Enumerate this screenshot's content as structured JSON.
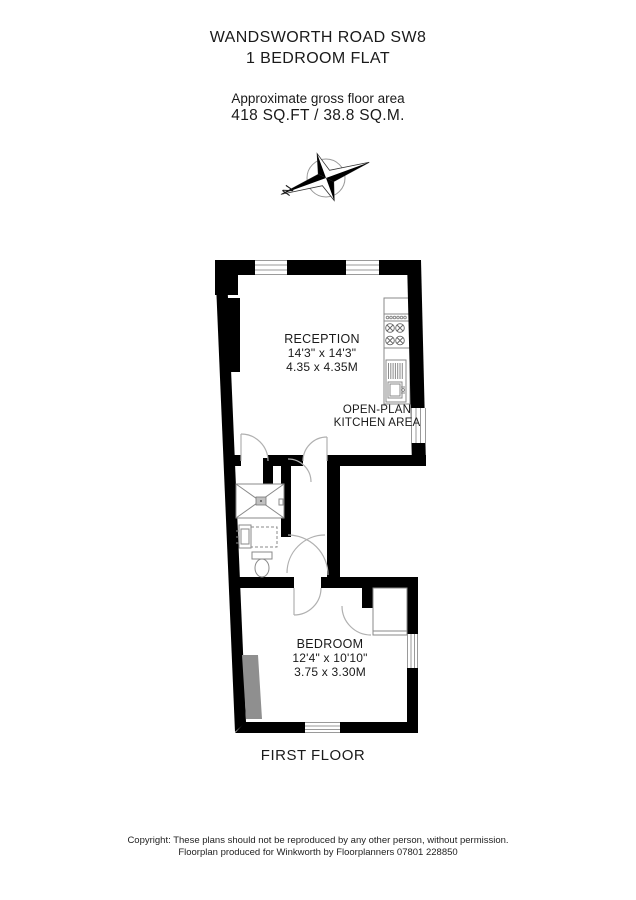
{
  "header": {
    "address": "WANDSWORTH ROAD SW8",
    "property_type": "1 BEDROOM FLAT",
    "area_label": "Approximate gross floor area",
    "area_value": "418 SQ.FT / 38.8 SQ.M."
  },
  "compass": {
    "north_label": "N"
  },
  "rooms": {
    "reception": {
      "name": "RECEPTION",
      "imperial": "14'3\" x 14'3\"",
      "metric": "4.35 x 4.35M"
    },
    "kitchen": {
      "line1": "OPEN-PLAN",
      "line2": "KITCHEN AREA"
    },
    "bedroom": {
      "name": "BEDROOM",
      "imperial": "12'4\" x 10'10\"",
      "metric": "3.75 x 3.30M"
    }
  },
  "floor_label": "FIRST FLOOR",
  "footer": {
    "line1": "Copyright: These plans should not be reproduced by any other person, without permission.",
    "line2": "Floorplan produced for Winkworth by Floorplanners 07801 228850"
  },
  "colors": {
    "wall": "#000000",
    "fixture_line": "#8a8a8a",
    "door_arc": "#b0b0b0",
    "gray_feature": "#8f8f8f"
  }
}
